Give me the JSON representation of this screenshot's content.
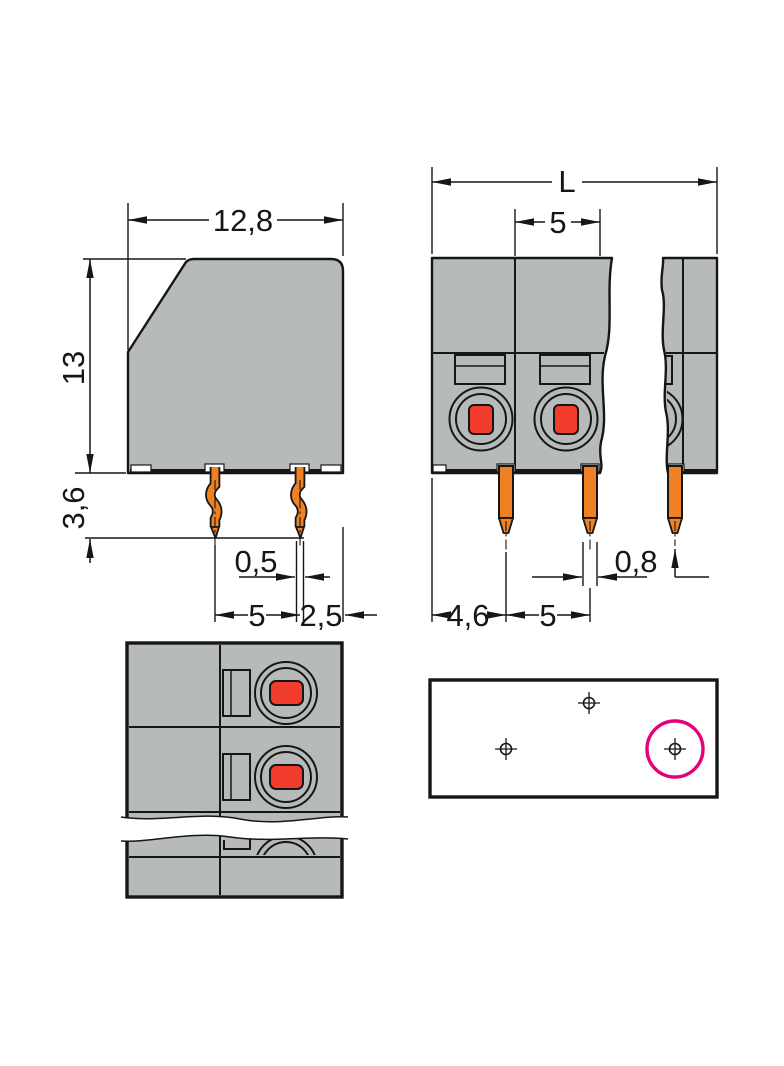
{
  "colors": {
    "body_gray": "#b6bbba",
    "line": "#161616",
    "pin_orange": "#ef8123",
    "clamp_red": "#f23c2c",
    "highlight_magenta": "#e5007d"
  },
  "dimensions": {
    "side_view": {
      "body_width": "12,8",
      "body_height": "13",
      "pin_length": "3,6",
      "pin_thickness": "0,5",
      "pin_pitch": "5",
      "pin_to_edge": "2,5"
    },
    "front_view": {
      "total_length": "L",
      "pole_width": "5",
      "edge_to_first_pin": "4,6",
      "pin_pitch": "5",
      "pin_width": "0,8"
    }
  }
}
